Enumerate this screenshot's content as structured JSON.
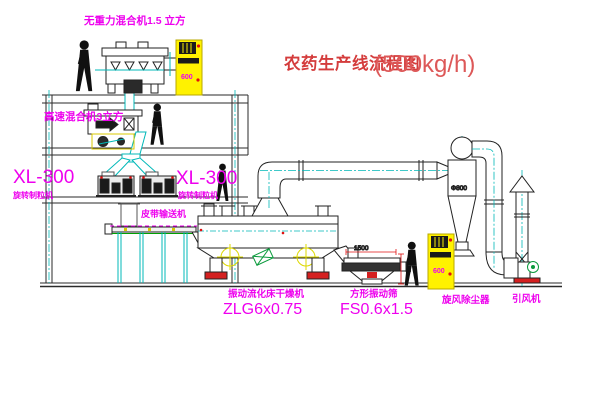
{
  "title": {
    "cn": "农药生产线流程图",
    "capacity": "(500kg/h)"
  },
  "labels": {
    "top_mixer": "无重力混合机1.5 立方",
    "floor2_mixer": "高速混合机3立方",
    "granulator_left_model": "XL-300",
    "granulator_left_name": "旋转制粒机",
    "granulator_right_model": "XL-300",
    "granulator_right_name": "旋转制粒机",
    "belt_conveyor": "皮带输送机",
    "dryer_name": "振动流化床干燥机",
    "dryer_model": "ZLG6x0.75",
    "screen_name": "方形振动筛",
    "screen_model": "FS0.6x1.5",
    "cyclone": "旋风除尘器",
    "fan": "引风机"
  },
  "dimensions": {
    "screen_width": "1500",
    "screen_drop": "540",
    "cyclone_dia": "Φ800"
  },
  "equipment_marks": {
    "elevator_top": "600",
    "elevator_right": "600"
  },
  "colors": {
    "label_magenta": "#ee00ee",
    "title_red": "#d43c3c",
    "dimension_red": "#e01010",
    "centerline_cyan": "#00b8b8",
    "structure_dark": "#2a2a2a",
    "elevator_yellow": "#fff200",
    "motor_green": "#0a9a3c",
    "conveyor_green": "#00a000",
    "crosshair_yellow": "#ddd800"
  }
}
